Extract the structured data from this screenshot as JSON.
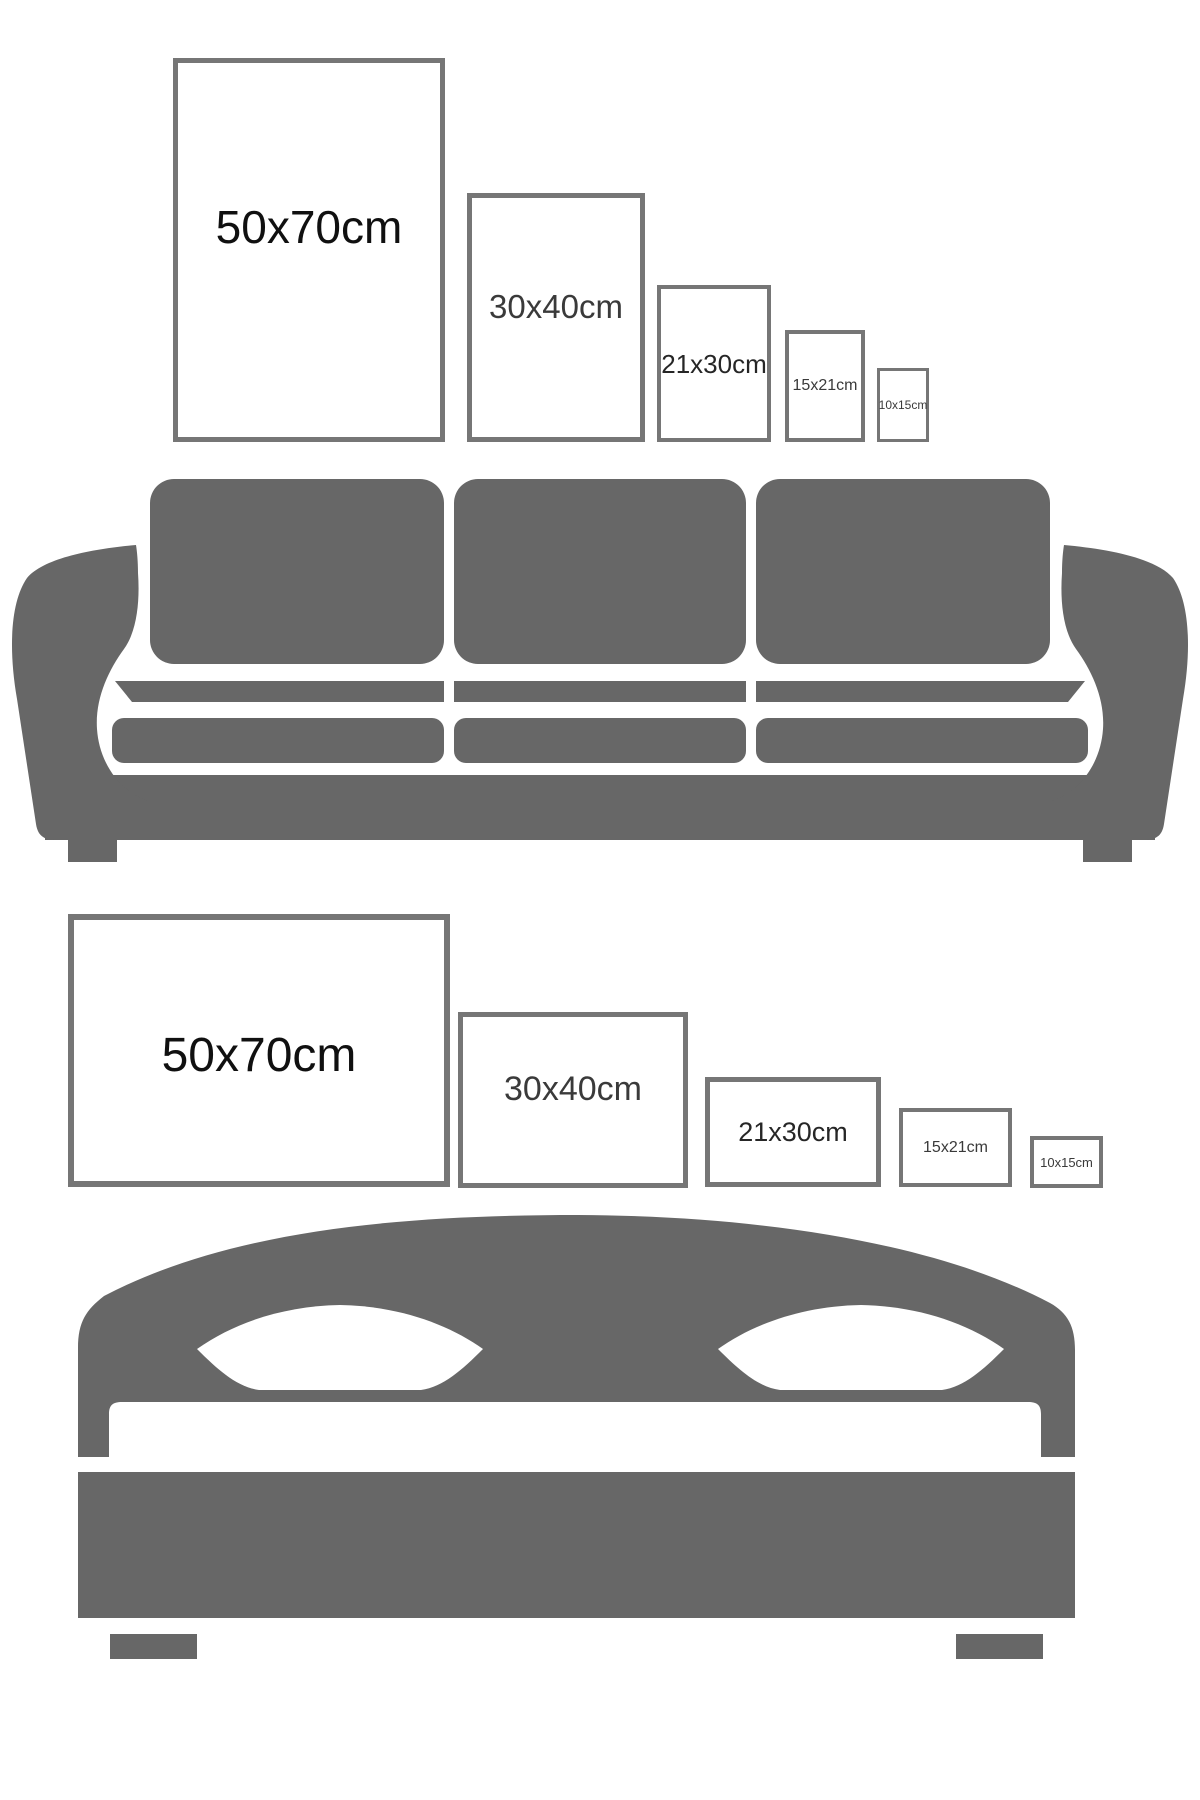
{
  "colors": {
    "background": "#ffffff",
    "furniture": "#676767",
    "frame_border": "#767676",
    "pillow_cutout": "#ffffff"
  },
  "sizes": {
    "portrait": [
      {
        "label": "50x70cm"
      },
      {
        "label": "30x40cm"
      },
      {
        "label": "21x30cm"
      },
      {
        "label": "15x21cm"
      },
      {
        "label": "10x15cm"
      }
    ],
    "landscape": [
      {
        "label": "50x70cm"
      },
      {
        "label": "30x40cm"
      },
      {
        "label": "21x30cm"
      },
      {
        "label": "15x21cm"
      },
      {
        "label": "10x15cm"
      }
    ]
  },
  "illustrations": {
    "sofa": "sofa-silhouette",
    "bed": "bed-silhouette"
  }
}
